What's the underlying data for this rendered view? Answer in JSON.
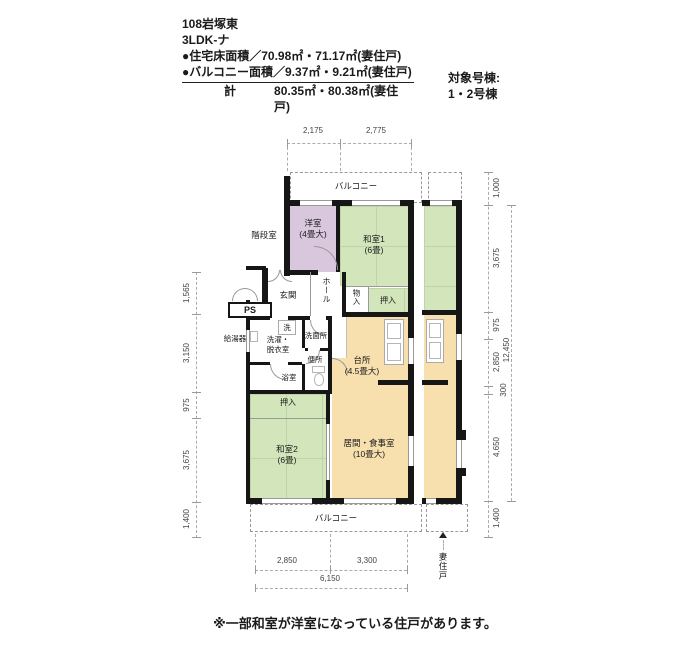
{
  "header": {
    "title": "108岩塚東",
    "plan_type": "3LDK-ナ",
    "floor_area_line": "●住宅床面積／70.98㎡・71.17㎡(妻住戸)",
    "balcony_area_line": "●バルコニー面積／9.37㎡・9.21㎡(妻住戸)",
    "total_label": "計",
    "total_value": "80.35㎡・80.38㎡(妻住戸)",
    "target_building_label": "対象号棟:",
    "target_building_value": "1・2号棟"
  },
  "plan": {
    "rooms": {
      "stairwell": "階段室",
      "western_room": {
        "name": "洋室",
        "size": "(4畳大)"
      },
      "japanese_room_1": {
        "name": "和室1",
        "size": "(6畳)"
      },
      "japanese_room_2": {
        "name": "和室2",
        "size": "(6畳)"
      },
      "kitchen": {
        "name": "台所",
        "size": "(4.5畳大)"
      },
      "living_dining": {
        "name": "居間・食事室",
        "size": "(10畳大)"
      },
      "entrance": "玄関",
      "hall": "ホール",
      "pipe_shaft": "PS",
      "water_heater": "給湯器",
      "washer": "洗",
      "laundry_line1": "洗濯・",
      "laundry_line2": "脱衣室",
      "washroom": "洗面所",
      "toilet": "便所",
      "bathroom": "浴室",
      "closet_upper": "押入",
      "storage": "物入",
      "closet_left": "押入",
      "balcony_top": "バルコニー",
      "balcony_bottom": "バルコニー",
      "end_unit": "妻住戸"
    },
    "dimensions": {
      "top": [
        "2,175",
        "2,775"
      ],
      "bottom": [
        "2,850",
        "3,300"
      ],
      "bottom_total": "6,150",
      "left": [
        "1,565",
        "3,150",
        "975",
        "3,675",
        "1,400"
      ],
      "right": [
        "1,000",
        "3,675",
        "975",
        "2,850",
        "300",
        "4,650",
        "1,400"
      ],
      "right_total": "12,450"
    }
  },
  "footer": {
    "note": "※一部和室が洋室になっている住戸があります。"
  },
  "colors": {
    "tatami_green": "#d3e5ba",
    "wood_purple": "#d9c7dd",
    "living_orange": "#f8dfae",
    "wall_black": "#161616"
  }
}
